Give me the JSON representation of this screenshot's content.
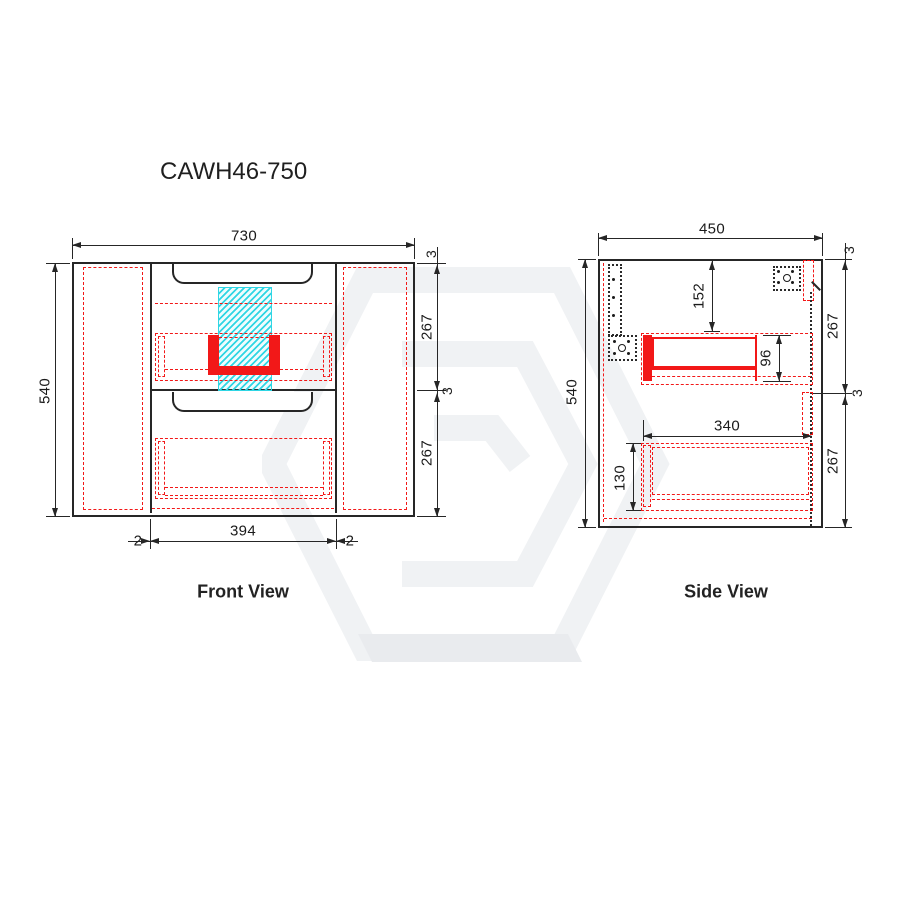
{
  "title": "CAWH46-750",
  "colors": {
    "line": "#262626",
    "red_accent": "#f21818",
    "cyan_hatch": "#2fd6e4",
    "watermark": "#f0f2f4",
    "text": "#1a1a1a"
  },
  "icons": {
    "watermark": "hexagon-logo-watermark",
    "brackets": "mounting-bracket-dotted"
  },
  "front_view": {
    "label": "Front View",
    "width": "730",
    "height": "540",
    "right_dims": [
      "3",
      "267",
      "3",
      "267"
    ],
    "bottom": {
      "gap_left": "2",
      "drawer_width": "394",
      "gap_right": "2"
    }
  },
  "side_view": {
    "label": "Side View",
    "depth": "450",
    "height": "540",
    "right_dims": [
      "3",
      "267",
      "3",
      "267"
    ],
    "inner": {
      "top_offset": "152",
      "drawer_box_height": "96",
      "drawer_depth": "340",
      "lower_drawer_height": "130"
    }
  }
}
